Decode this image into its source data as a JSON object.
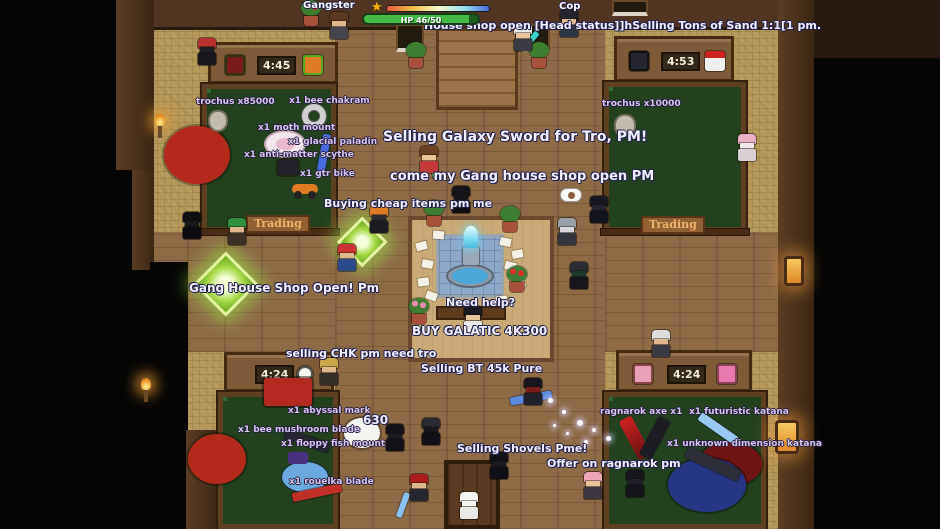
{
  "colors": {
    "chat_text": "#f2f0ff",
    "item_text": "#d6c6f0",
    "hp_bar": "#44bb44"
  },
  "hud": {
    "player_left": "Gangster",
    "player_right": "Cop",
    "hp_text": "HP 46/50",
    "star": "★",
    "xp_colors": [
      "#e85540",
      "#f0c040",
      "#f8f8c8",
      "#9ee4ee",
      "#4868d8"
    ]
  },
  "rooms": {
    "top_left": {
      "sign": "4:45"
    },
    "top_right": {
      "sign": "4:53"
    },
    "bottom_left": {
      "sign": "4:24"
    },
    "bottom_right": {
      "sign": "4:24"
    }
  },
  "plaques": {
    "left": "Trading",
    "right": "Trading"
  },
  "overlay_texts": [
    {
      "n": "chat-house-shop",
      "text": "House shop open [Head status]]hSelling Tons of Sand 1:1[1 pm.",
      "x": 424,
      "y": 19,
      "cls": "chat",
      "fs": 11
    },
    {
      "n": "chat-selling-galaxy-sword",
      "text": "Selling Galaxy Sword for Tro, PM!",
      "x": 383,
      "y": 129,
      "cls": "chat",
      "fs": 14
    },
    {
      "n": "chat-gang-house-open",
      "text": "come my Gang house shop open PM",
      "x": 390,
      "y": 169,
      "cls": "chat",
      "fs": 13
    },
    {
      "n": "chat-buying-cheap-items",
      "text": "Buying cheap items pm me",
      "x": 324,
      "y": 197,
      "cls": "chat",
      "fs": 11
    },
    {
      "n": "chat-gang-house-shop-open",
      "text": "Gang House Shop Open! Pm",
      "x": 189,
      "y": 281,
      "cls": "chat",
      "fs": 12
    },
    {
      "n": "chat-need-help",
      "text": "Need help?",
      "x": 446,
      "y": 296,
      "cls": "chat",
      "fs": 11
    },
    {
      "n": "chat-buy-galatic",
      "text": "BUY GALATIC 4K300",
      "x": 412,
      "y": 324,
      "cls": "chat",
      "fs": 12
    },
    {
      "n": "chat-selling-chk",
      "text": "selling CHK pm need tro",
      "x": 286,
      "y": 347,
      "cls": "chat",
      "fs": 11
    },
    {
      "n": "chat-selling-bt",
      "text": "Selling BT 45k Pure",
      "x": 421,
      "y": 362,
      "cls": "chat",
      "fs": 11
    },
    {
      "n": "chat-selling-shovels",
      "text": "Selling Shovels Pme!",
      "x": 457,
      "y": 442,
      "cls": "chat",
      "fs": 11
    },
    {
      "n": "chat-offer-ragnarok",
      "text": "Offer on ragnarok pm",
      "x": 547,
      "y": 457,
      "cls": "chat",
      "fs": 11
    },
    {
      "n": "count-630",
      "text": "630",
      "x": 363,
      "y": 413,
      "cls": "chat",
      "fs": 12
    },
    {
      "n": "item-trochus-85000",
      "text": "trochus x85000",
      "x": 196,
      "y": 97,
      "cls": "item",
      "fs": 9
    },
    {
      "n": "item-bee-chakram",
      "text": "x1 bee chakram",
      "x": 289,
      "y": 96,
      "cls": "item",
      "fs": 9
    },
    {
      "n": "item-moth-mount",
      "text": "x1 moth mount",
      "x": 258,
      "y": 123,
      "cls": "item",
      "fs": 9
    },
    {
      "n": "item-glacial-paladin",
      "text": "x1 glacial paladin",
      "x": 288,
      "y": 137,
      "cls": "item",
      "fs": 9
    },
    {
      "n": "item-anti-matter",
      "text": "x1 anti-matter scythe",
      "x": 244,
      "y": 150,
      "cls": "item",
      "fs": 9
    },
    {
      "n": "item-gtr-bike",
      "text": "x1 gtr bike",
      "x": 300,
      "y": 169,
      "cls": "item",
      "fs": 9
    },
    {
      "n": "item-trochus-10000",
      "text": "trochus x10000",
      "x": 602,
      "y": 99,
      "cls": "item",
      "fs": 9
    },
    {
      "n": "item-abyssal-mark",
      "text": "x1 abyssal mark",
      "x": 288,
      "y": 406,
      "cls": "item",
      "fs": 9
    },
    {
      "n": "item-bee-mushroom-blade",
      "text": "x1 bee mushroom blade",
      "x": 238,
      "y": 425,
      "cls": "item",
      "fs": 9
    },
    {
      "n": "item-floppy-fish-mount",
      "text": "x1 floppy fish mount",
      "x": 281,
      "y": 439,
      "cls": "item",
      "fs": 9
    },
    {
      "n": "item-rouelka-blade",
      "text": "x1 rouelka blade",
      "x": 289,
      "y": 477,
      "cls": "item",
      "fs": 9
    },
    {
      "n": "item-ragnarok-axe",
      "text": "ragnarok axe x1",
      "x": 600,
      "y": 407,
      "cls": "item",
      "fs": 9
    },
    {
      "n": "item-futuristic-katana",
      "text": "x1 futuristic katana",
      "x": 689,
      "y": 407,
      "cls": "item",
      "fs": 9
    },
    {
      "n": "item-unknown-dimension-katana",
      "text": "x1 unknown dimension katana",
      "x": 667,
      "y": 439,
      "cls": "item",
      "fs": 9
    }
  ],
  "sprites": [
    {
      "k": "ellipse",
      "n": "rug-red",
      "x": 164,
      "y": 126,
      "w": 66,
      "h": 58,
      "c": "#b3291b"
    },
    {
      "k": "ellipse",
      "n": "rug-red",
      "x": 188,
      "y": 434,
      "w": 58,
      "h": 50,
      "c": "#b3291b"
    },
    {
      "k": "ellipse",
      "n": "rug-dark-red",
      "x": 698,
      "y": 442,
      "w": 64,
      "h": 44,
      "c": "#701515"
    },
    {
      "k": "ellipse",
      "n": "rug-blue",
      "x": 668,
      "y": 458,
      "w": 78,
      "h": 54,
      "c": "#273585"
    },
    {
      "k": "paper",
      "x": 416,
      "y": 242,
      "r": -15
    },
    {
      "k": "paper",
      "x": 422,
      "y": 260,
      "r": 10
    },
    {
      "k": "paper",
      "x": 418,
      "y": 278,
      "r": -8
    },
    {
      "k": "paper",
      "x": 426,
      "y": 292,
      "r": 20
    },
    {
      "k": "paper",
      "x": 500,
      "y": 238,
      "r": 12
    },
    {
      "k": "paper",
      "x": 512,
      "y": 250,
      "r": -10
    },
    {
      "k": "paper",
      "x": 505,
      "y": 262,
      "r": 15
    },
    {
      "k": "paper",
      "x": 514,
      "y": 280,
      "r": -18
    },
    {
      "k": "paper",
      "x": 433,
      "y": 231,
      "r": 5
    },
    {
      "k": "paper",
      "x": 496,
      "y": 296,
      "r": -5
    },
    {
      "k": "plant",
      "x": 404,
      "y": 42
    },
    {
      "k": "plant",
      "x": 527,
      "y": 42
    },
    {
      "k": "plant",
      "x": 422,
      "y": 200
    },
    {
      "k": "plant",
      "x": 498,
      "y": 206
    },
    {
      "k": "flower",
      "x": 505,
      "y": 266,
      "c": "#d93025"
    },
    {
      "k": "flower",
      "x": 407,
      "y": 298,
      "c": "#e88ab0"
    },
    {
      "k": "flower",
      "x": 299,
      "y": 0,
      "c": "#d93025"
    },
    {
      "k": "diamond",
      "n": "glow-diamond",
      "x": 338,
      "y": 218,
      "s": 48
    },
    {
      "k": "diamond",
      "n": "glow-diamond",
      "x": 196,
      "y": 254,
      "s": 60
    },
    {
      "k": "ring",
      "n": "item-sprite-chakram",
      "x": 302,
      "y": 104,
      "d": 24
    },
    {
      "k": "pouch",
      "n": "item-sprite-trochus",
      "x": 208,
      "y": 110,
      "w": 20,
      "h": 22
    },
    {
      "k": "pouch",
      "n": "item-sprite-trochus",
      "x": 614,
      "y": 114,
      "w": 22,
      "h": 24
    },
    {
      "k": "moth",
      "n": "item-sprite-moth",
      "x": 264,
      "y": 130,
      "w": 42,
      "h": 28
    },
    {
      "k": "blade",
      "n": "item-sprite-blue-sword",
      "x": 320,
      "y": 134,
      "w": 8,
      "h": 38,
      "r": 10,
      "c": "#4a6ae0"
    },
    {
      "k": "rect",
      "n": "item-sprite-box",
      "x": 278,
      "y": 160,
      "w": 20,
      "h": 15,
      "c": "#23232b"
    },
    {
      "k": "bike",
      "n": "item-sprite-bike",
      "x": 292,
      "y": 178
    },
    {
      "k": "rect",
      "n": "item-sprite-sled",
      "x": 264,
      "y": 378,
      "w": 48,
      "h": 28,
      "c": "#b32a22"
    },
    {
      "k": "blade",
      "n": "item-sprite-dark-blade",
      "x": 284,
      "y": 436,
      "w": 46,
      "h": 10,
      "r": 18,
      "c": "#262630"
    },
    {
      "k": "fish",
      "n": "item-sprite-fish",
      "x": 278,
      "y": 448
    },
    {
      "k": "blade",
      "n": "item-sprite-red-blade",
      "x": 292,
      "y": 488,
      "w": 50,
      "h": 9,
      "r": -12,
      "c": "#c03028"
    },
    {
      "k": "axe",
      "n": "item-sprite-ragnarok-axe",
      "x": 624,
      "y": 414
    },
    {
      "k": "blade",
      "n": "item-sprite-futuristic-katana",
      "x": 696,
      "y": 424,
      "w": 44,
      "h": 9,
      "r": 35,
      "c": "#9ac8f0"
    },
    {
      "k": "blade",
      "n": "item-sprite-unknown-katana",
      "x": 684,
      "y": 458,
      "w": 58,
      "h": 12,
      "r": 25,
      "c": "#2e2e38"
    },
    {
      "k": "blade",
      "n": "item-sprite-dropped-katana",
      "x": 510,
      "y": 394,
      "w": 42,
      "h": 8,
      "r": -10,
      "c": "#5a8ae0"
    },
    {
      "k": "torch",
      "x": 152,
      "y": 114
    },
    {
      "k": "torch",
      "x": 138,
      "y": 378
    },
    {
      "k": "lamp",
      "x": 784,
      "y": 256,
      "w": 20,
      "h": 30
    },
    {
      "k": "lamp",
      "x": 775,
      "y": 420,
      "w": 24,
      "h": 34
    },
    {
      "k": "emote",
      "x": 560,
      "y": 188
    },
    {
      "k": "person",
      "x": 512,
      "y": 24,
      "hat": "#e8e8e4",
      "skin": "#e8c49a",
      "body": "#3a3a42"
    },
    {
      "k": "blade",
      "n": "item-sprite-pickaxe",
      "x": 528,
      "y": 30,
      "w": 6,
      "h": 20,
      "r": 40,
      "c": "#3ad4c8"
    },
    {
      "k": "person",
      "x": 558,
      "y": 10,
      "hat": "#23232b",
      "skin": "#e0b890",
      "body": "#2e3642"
    },
    {
      "k": "person",
      "x": 328,
      "y": 12,
      "hat": "#5a3a22",
      "skin": "#e0b890",
      "body": "#44444c"
    },
    {
      "k": "person",
      "x": 418,
      "y": 146,
      "hat": "#6b4226",
      "skin": "#e8c49a",
      "body": "#c43a3a"
    },
    {
      "k": "blade",
      "n": "item-sprite-galaxy-sword",
      "x": 430,
      "y": 150,
      "w": 6,
      "h": 30,
      "r": -15,
      "c": "#3ad48a"
    },
    {
      "k": "person",
      "x": 450,
      "y": 186,
      "hat": "#15151a",
      "skin": "#15151a",
      "body": "#101014"
    },
    {
      "k": "person",
      "x": 588,
      "y": 196,
      "hat": "#181820",
      "skin": "#23232e",
      "body": "#14141c"
    },
    {
      "k": "person",
      "x": 556,
      "y": 218,
      "hat": "#9aa0a8",
      "skin": "#d8d8dc",
      "body": "#33363e"
    },
    {
      "k": "person",
      "x": 226,
      "y": 218,
      "hat": "#2f8f3f",
      "skin": "#e0b890",
      "body": "#3a3026"
    },
    {
      "k": "person",
      "x": 181,
      "y": 212,
      "hat": "#101014",
      "skin": "#17171c",
      "body": "#0c0c10"
    },
    {
      "k": "person",
      "x": 336,
      "y": 244,
      "hat": "#cc3333",
      "skin": "#e0b890",
      "body": "#2c4a8a"
    },
    {
      "k": "person",
      "x": 368,
      "y": 206,
      "hat": "#df7b22",
      "skin": "#2a2a30",
      "body": "#1c1c22"
    },
    {
      "k": "person",
      "x": 462,
      "y": 306,
      "hat": "#191920",
      "skin": "#e8c49a",
      "body": "#ececec"
    },
    {
      "k": "person",
      "x": 318,
      "y": 358,
      "hat": "#c9a84c",
      "skin": "#e0b890",
      "body": "#332e28"
    },
    {
      "k": "person",
      "x": 522,
      "y": 378,
      "hat": "#16161c",
      "skin": "#7a1d1d",
      "body": "#20202a"
    },
    {
      "k": "person",
      "x": 408,
      "y": 474,
      "hat": "#a91d1d",
      "skin": "#e0b890",
      "body": "#26262e"
    },
    {
      "k": "blade",
      "n": "item-sprite-held-katana",
      "x": 400,
      "y": 492,
      "w": 6,
      "h": 26,
      "r": 20,
      "c": "#8ac0f0"
    },
    {
      "k": "person",
      "x": 458,
      "y": 492,
      "hat": "#f4f4f0",
      "skin": "#f4f4f0",
      "body": "#e8e8e4"
    },
    {
      "k": "person",
      "x": 488,
      "y": 452,
      "hat": "#121216",
      "skin": "#18181e",
      "body": "#101016"
    },
    {
      "k": "person",
      "x": 582,
      "y": 472,
      "hat": "#eda4b6",
      "skin": "#e8c49a",
      "body": "#3c3640"
    },
    {
      "k": "person",
      "x": 736,
      "y": 134,
      "hat": "#e8b2c4",
      "skin": "#f0e8e8",
      "body": "#d8d0d4"
    },
    {
      "k": "person",
      "x": 650,
      "y": 330,
      "hat": "#dedede",
      "skin": "#e0b890",
      "body": "#3a3a44"
    },
    {
      "k": "person",
      "x": 384,
      "y": 424,
      "hat": "#141418",
      "skin": "#1a1a20",
      "body": "#121218"
    },
    {
      "k": "person",
      "x": 420,
      "y": 418,
      "hat": "#2a2a32",
      "skin": "#17171d",
      "body": "#101016"
    },
    {
      "k": "person",
      "x": 568,
      "y": 262,
      "hat": "#2c2c34",
      "skin": "#1d3a2e",
      "body": "#16161c"
    },
    {
      "k": "person",
      "x": 196,
      "y": 38,
      "hat": "#b83030",
      "skin": "#1d1d24",
      "body": "#17171d"
    },
    {
      "k": "person",
      "x": 624,
      "y": 470,
      "hat": "#16161c",
      "skin": "#20202a",
      "body": "#14141a"
    },
    {
      "k": "ellipse",
      "n": "character-blob",
      "x": 344,
      "y": 418,
      "w": 36,
      "h": 30,
      "c": "#f3f3ef"
    },
    {
      "k": "spark",
      "x": 548,
      "y": 398,
      "d": 5
    },
    {
      "k": "spark",
      "x": 562,
      "y": 410,
      "d": 4
    },
    {
      "k": "spark",
      "x": 577,
      "y": 420,
      "d": 6
    },
    {
      "k": "spark",
      "x": 592,
      "y": 428,
      "d": 4
    },
    {
      "k": "spark",
      "x": 606,
      "y": 436,
      "d": 5
    },
    {
      "k": "spark",
      "x": 566,
      "y": 432,
      "d": 3
    },
    {
      "k": "spark",
      "x": 553,
      "y": 424,
      "d": 3
    },
    {
      "k": "spark",
      "x": 584,
      "y": 440,
      "d": 4
    }
  ]
}
